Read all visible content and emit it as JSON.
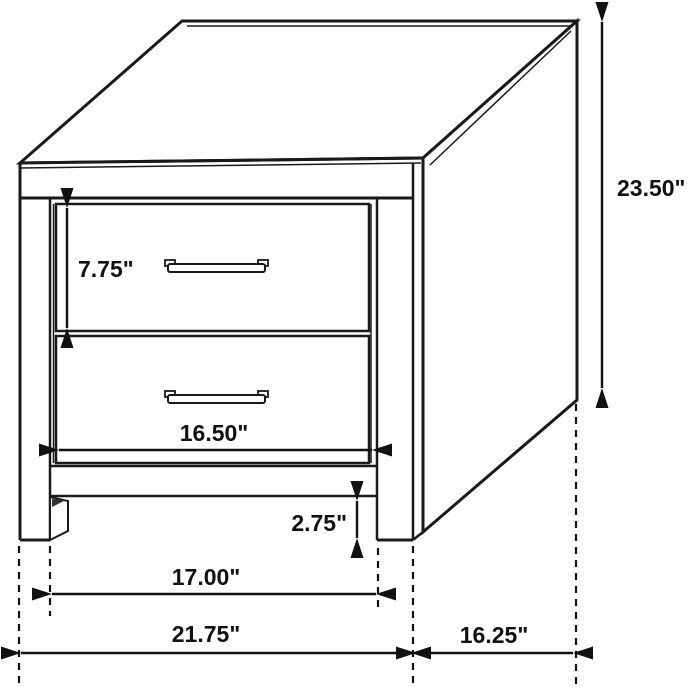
{
  "diagram": {
    "name": "two-drawer nightstand dimension diagram",
    "background_color": "#ffffff",
    "line_color": "#1a1a1a",
    "dimensions": {
      "overall_height": "23.50\"",
      "top_drawer_height": "7.75\"",
      "drawer_width": "16.50\"",
      "base_clearance": "2.75\"",
      "leg_inner_span": "17.00\"",
      "overall_width": "21.75\"",
      "depth": "16.25\""
    }
  }
}
